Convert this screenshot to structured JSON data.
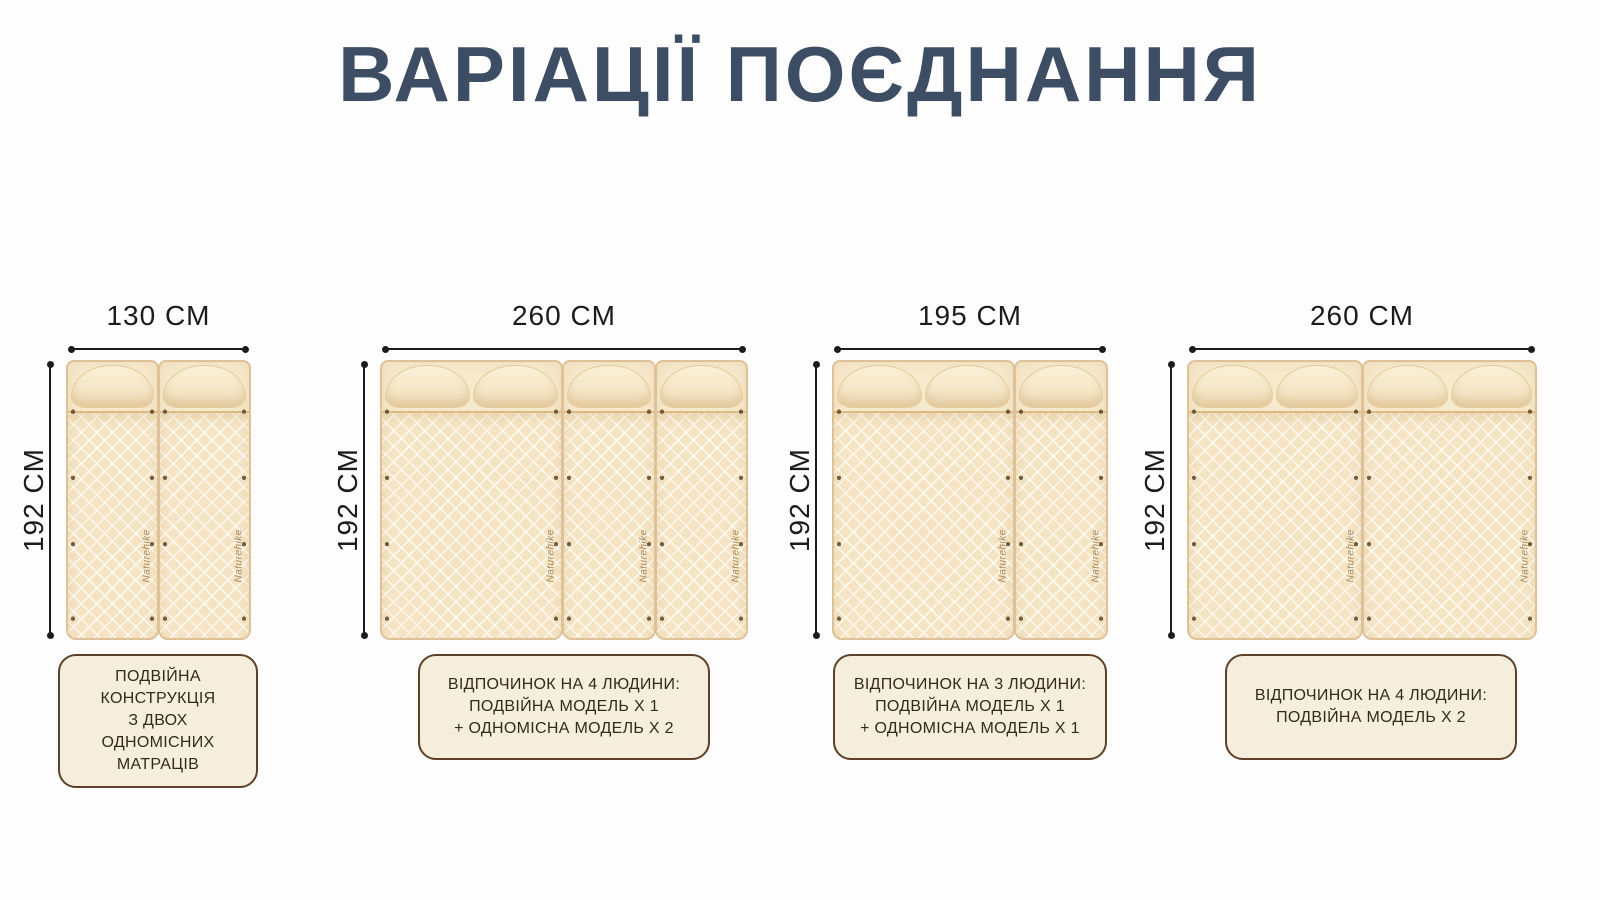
{
  "page": {
    "background_color": "#fdfdfd"
  },
  "title": {
    "text": "ВАРІАЦІЇ ПОЄДНАННЯ",
    "color": "#3d4d63"
  },
  "brand_label": "Naturehike",
  "colors": {
    "dimension_lines": "#1c1c1c",
    "mattress_body": "#f4e4c4",
    "mattress_border": "#dfc197",
    "pillow": "#f7ecd0",
    "caption_box_bg": "#f6eedc",
    "caption_box_border": "#5d4128",
    "caption_text": "#33291d"
  },
  "panels": [
    {
      "width_label": "130 CM",
      "height_label": "192 CM",
      "caption": "ПОДВІЙНА\nКОНСТРУКЦІЯ\nЗ ДВОХ ОДНОМІСНИХ\nМАТРАЦІВ",
      "composition": [
        "single",
        "single"
      ]
    },
    {
      "width_label": "260 CM",
      "height_label": "192 CM",
      "caption": "ВІДПОЧИНОК НА 4 ЛЮДИНИ:\nПОДВІЙНА МОДЕЛЬ Х 1\n+ ОДНОМІСНА МОДЕЛЬ Х 2",
      "composition": [
        "double",
        "single",
        "single"
      ]
    },
    {
      "width_label": "195 CM",
      "height_label": "192 CM",
      "caption": "ВІДПОЧИНОК НА 3 ЛЮДИНИ:\nПОДВІЙНА МОДЕЛЬ Х 1\n+ ОДНОМІСНА МОДЕЛЬ Х 1",
      "composition": [
        "double",
        "single"
      ]
    },
    {
      "width_label": "260 CM",
      "height_label": "192 CM",
      "caption": "ВІДПОЧИНОК НА 4 ЛЮДИНИ:\nПОДВІЙНА МОДЕЛЬ Х 2",
      "composition": [
        "double",
        "double"
      ]
    }
  ]
}
